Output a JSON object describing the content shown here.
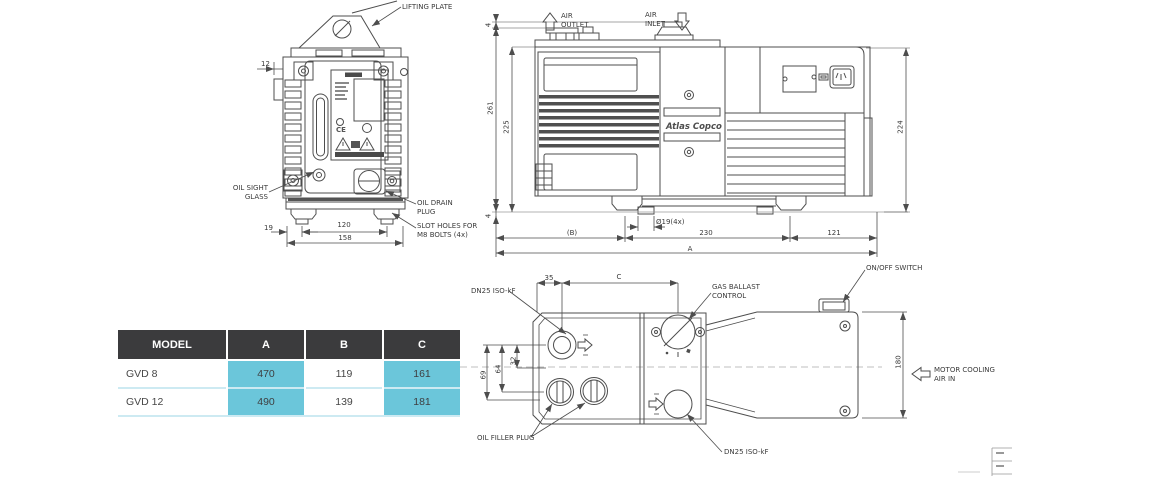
{
  "page": {
    "background": "#ffffff",
    "line_color": "#4d4d4d"
  },
  "front_view": {
    "labels": {
      "lifting_plate": "LIFTING PLATE",
      "oil_sight_glass": "OIL SIGHT\nGLASS",
      "oil_drain_plug": "OIL DRAIN\nPLUG",
      "slot_holes": "SLOT HOLES FOR\nM8 BOLTS (4x)"
    },
    "nameplate_ce": "CE",
    "dims": {
      "top_offset": "12",
      "foot_inset": "19",
      "foot_spacing": "120",
      "base_width": "158"
    }
  },
  "side_view": {
    "labels": {
      "air_outlet": "AIR\nOUTLET",
      "air_inlet": "AIR\nINLET",
      "brand": "Atlas Copco"
    },
    "dims": {
      "flange_height": "4",
      "total_height": "261",
      "body_height": "225",
      "motor_height": "224",
      "foot_height": "4",
      "dim_b": "(B)",
      "bolt_holes": "Ø19(4x)",
      "foot_span": "230",
      "motor_overhang": "121",
      "dim_a": "A"
    }
  },
  "top_view": {
    "labels": {
      "dn25_top": "DN25 ISO-kF",
      "gas_ballast": "GAS BALLAST\nCONTROL",
      "on_off_switch": "ON/OFF SWITCH",
      "motor_cooling": "MOTOR COOLING\nAIR IN",
      "oil_filler_plug": "OIL FILLER PLUG",
      "dn25_bottom": "DN25 ISO-kF"
    },
    "dims": {
      "port_offset": "35",
      "dim_c": "C",
      "d32": "32",
      "d64": "64",
      "d69": "69",
      "motor_width": "180"
    }
  },
  "table": {
    "columns": [
      "MODEL",
      "A",
      "B",
      "C"
    ],
    "rows": [
      {
        "model": "GVD 8",
        "a": "470",
        "b": "119",
        "c": "161"
      },
      {
        "model": "GVD 12",
        "a": "490",
        "b": "139",
        "c": "181"
      }
    ],
    "style": {
      "header_bg": "#3b3b3d",
      "header_text": "#ffffff",
      "highlight": "#6bc6da",
      "divider": "#cdeaf2"
    }
  }
}
